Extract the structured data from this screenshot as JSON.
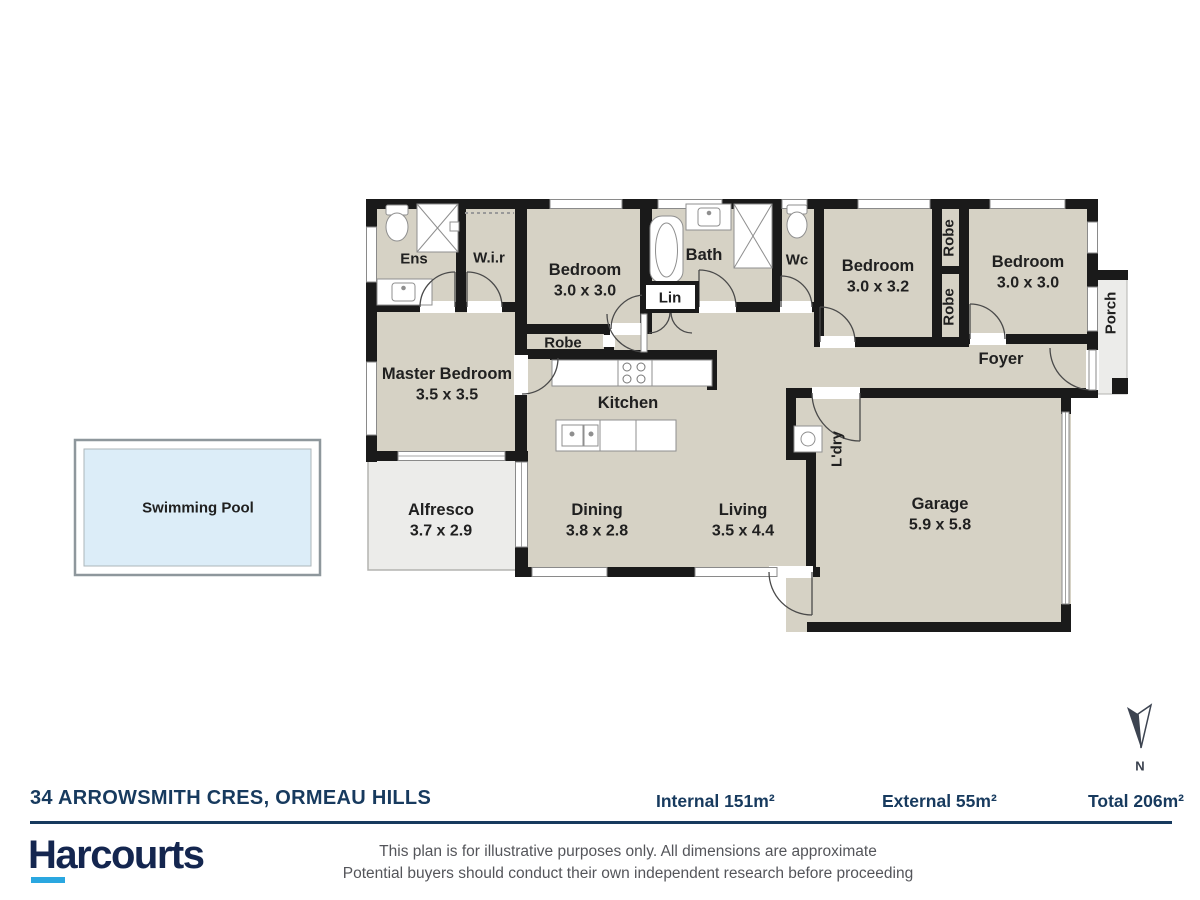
{
  "plan": {
    "labels": {
      "ens": "Ens",
      "wir": "W.i.r",
      "bedroom1_name": "Bedroom",
      "bedroom1_dims": "3.0 x 3.0",
      "bath": "Bath",
      "lin": "Lin",
      "wc": "Wc",
      "bedroom2_name": "Bedroom",
      "bedroom2_dims": "3.0 x 3.2",
      "robe_top": "Robe",
      "robe_bottom": "Robe",
      "bedroom3_name": "Bedroom",
      "bedroom3_dims": "3.0 x 3.0",
      "porch": "Porch",
      "foyer": "Foyer",
      "robe_small": "Robe",
      "master_name": "Master Bedroom",
      "master_dims": "3.5 x 3.5",
      "kitchen": "Kitchen",
      "alfresco_name": "Alfresco",
      "alfresco_dims": "3.7 x 2.9",
      "dining_name": "Dining",
      "dining_dims": "3.8 x 2.8",
      "living_name": "Living",
      "living_dims": "3.5 x 4.4",
      "ldry": "L'dry",
      "garage_name": "Garage",
      "garage_dims": "5.9 x 5.8",
      "pool": "Swimming Pool"
    }
  },
  "footer": {
    "address": "34 ARROWSMITH CRES, ORMEAU HILLS",
    "internal": "Internal 151m²",
    "external": "External 55m²",
    "total": "Total 206m²",
    "logo": "Harcourts",
    "disclaimer_line1": "This plan is for illustrative purposes only. All dimensions are approximate",
    "disclaimer_line2": "Potential buyers should conduct their own independent research before proceeding"
  },
  "compass": {
    "label": "N"
  },
  "colors": {
    "wall": "#1a1a1a",
    "room_fill": "#d6d2c5",
    "external_fill": "#ececea",
    "pool_fill": "#dcedf8",
    "navy": "#173a5e",
    "logo_navy": "#14264f",
    "cyan": "#2aa7e0",
    "disclaimer_gray": "#54555a"
  }
}
